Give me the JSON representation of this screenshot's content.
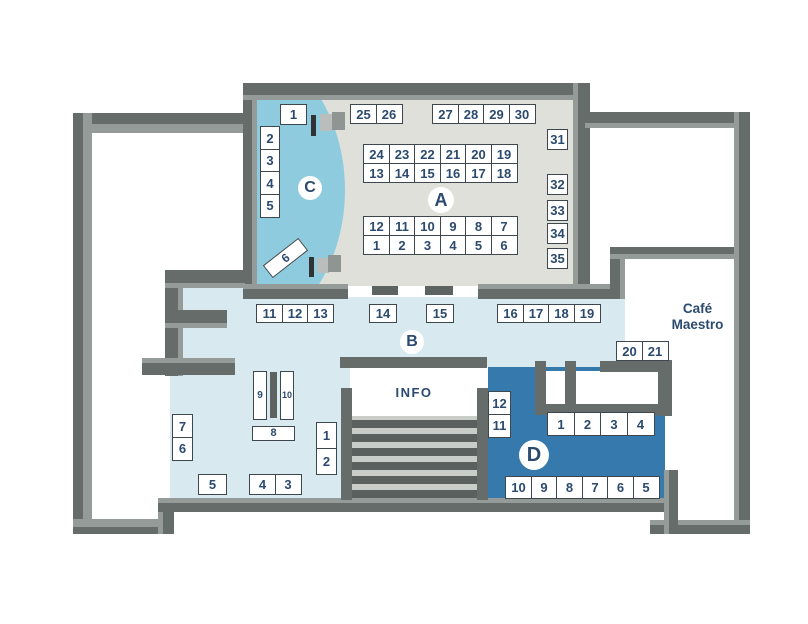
{
  "labels": {
    "info": "INFO",
    "cafe_line1": "Café",
    "cafe_line2": "Maestro"
  },
  "colors": {
    "wd": "#666c69",
    "wl": "#959b98",
    "wm": "#5d6360",
    "floor_a": "#e0e0db",
    "zone_b": "#d8eaf0",
    "zone_c": "#8ecbdf",
    "zone_d": "#3579ad",
    "stairs_bg": "#c9cdc9",
    "stair_step": "#5a605d",
    "booth_border": "#3e474d",
    "text": "#2b4a6e",
    "door_dark": "#2f3335",
    "door_grey1": "#b9bdbb",
    "door_grey2": "#8f9592"
  },
  "zones": [
    {
      "label": "A",
      "cx": 441,
      "cy": 200,
      "r": 13
    },
    {
      "label": "B",
      "cx": 412,
      "cy": 342,
      "r": 12
    },
    {
      "label": "C",
      "cx": 310,
      "cy": 188,
      "r": 12
    },
    {
      "label": "D",
      "cx": 534,
      "cy": 455,
      "r": 15
    }
  ],
  "booth_groups": [
    {
      "zone": "A",
      "x": 350,
      "y": 104,
      "cw": 27,
      "ch": 20,
      "cells": [
        "25",
        "26"
      ]
    },
    {
      "zone": "A",
      "x": 432,
      "y": 104,
      "cw": 27,
      "ch": 20,
      "cells": [
        "27",
        "28",
        "29",
        "30"
      ]
    },
    {
      "zone": "A",
      "x": 363,
      "y": 144,
      "cw": 27,
      "ch": 20,
      "cells": [
        "24",
        "23",
        "22",
        "21",
        "20",
        "19"
      ]
    },
    {
      "zone": "A",
      "x": 363,
      "y": 163,
      "cw": 27,
      "ch": 20,
      "cells": [
        "13",
        "14",
        "15",
        "16",
        "17",
        "18"
      ]
    },
    {
      "zone": "A",
      "x": 363,
      "y": 216,
      "cw": 27,
      "ch": 20,
      "cells": [
        "12",
        "11",
        "10",
        "9",
        "8",
        "7"
      ]
    },
    {
      "zone": "A",
      "x": 363,
      "y": 235,
      "cw": 27,
      "ch": 20,
      "cells": [
        "1",
        "2",
        "3",
        "4",
        "5",
        "6"
      ]
    },
    {
      "zone": "A",
      "x": 547,
      "y": 129,
      "cw": 21,
      "ch": 21,
      "cells": [
        "31"
      ]
    },
    {
      "zone": "A",
      "x": 547,
      "y": 174,
      "cw": 21,
      "ch": 21,
      "cells": [
        "32"
      ]
    },
    {
      "zone": "A",
      "x": 547,
      "y": 200,
      "cw": 21,
      "ch": 21,
      "cells": [
        "33"
      ]
    },
    {
      "zone": "A",
      "x": 547,
      "y": 223,
      "cw": 21,
      "ch": 21,
      "cells": [
        "34"
      ]
    },
    {
      "zone": "A",
      "x": 547,
      "y": 248,
      "cw": 21,
      "ch": 21,
      "cells": [
        "35"
      ]
    },
    {
      "zone": "C",
      "x": 280,
      "y": 104,
      "cw": 27,
      "ch": 21,
      "cells": [
        "1"
      ]
    },
    {
      "zone": "C",
      "x": 260,
      "y": 126,
      "dir": "col",
      "cw": 20,
      "ch": 24,
      "cells": [
        "2",
        "3",
        "4",
        "5"
      ]
    },
    {
      "zone": "C",
      "x": 263,
      "y": 250,
      "cw": 45,
      "ch": 16,
      "cells": [
        "6"
      ],
      "rot": -38,
      "fs": 12
    },
    {
      "zone": "B",
      "x": 256,
      "y": 304,
      "cw": 27,
      "ch": 19,
      "cells": [
        "11",
        "12",
        "13"
      ]
    },
    {
      "zone": "B",
      "x": 369,
      "y": 304,
      "cw": 28,
      "ch": 19,
      "cells": [
        "14"
      ]
    },
    {
      "zone": "B",
      "x": 426,
      "y": 304,
      "cw": 28,
      "ch": 19,
      "cells": [
        "15"
      ]
    },
    {
      "zone": "B",
      "x": 497,
      "y": 304,
      "cw": 27,
      "ch": 19,
      "cells": [
        "16",
        "17",
        "18",
        "19"
      ]
    },
    {
      "zone": "B",
      "x": 616,
      "y": 341,
      "cw": 27,
      "ch": 20,
      "cells": [
        "20",
        "21"
      ]
    },
    {
      "zone": "B",
      "x": 172,
      "y": 414,
      "dir": "col",
      "cw": 21,
      "ch": 24,
      "cells": [
        "7",
        "6"
      ]
    },
    {
      "zone": "B",
      "x": 198,
      "y": 474,
      "cw": 29,
      "ch": 21,
      "cells": [
        "5"
      ]
    },
    {
      "zone": "B",
      "x": 249,
      "y": 474,
      "cw": 27,
      "ch": 21,
      "cells": [
        "4",
        "3"
      ]
    },
    {
      "zone": "B",
      "x": 253,
      "y": 371,
      "cw": 14,
      "ch": 49,
      "cells": [
        "9"
      ],
      "fs": 10
    },
    {
      "zone": "B",
      "x": 280,
      "y": 371,
      "cw": 14,
      "ch": 49,
      "cells": [
        "10"
      ],
      "fs": 9
    },
    {
      "zone": "B",
      "x": 252,
      "y": 426,
      "cw": 43,
      "ch": 15,
      "cells": [
        "8"
      ],
      "fs": 11
    },
    {
      "zone": "B",
      "x": 316,
      "y": 422,
      "dir": "col",
      "cw": 21,
      "ch": 27,
      "cells": [
        "1",
        "2"
      ]
    },
    {
      "zone": "D",
      "x": 488,
      "y": 391,
      "dir": "col",
      "cw": 23,
      "ch": 24,
      "cells": [
        "12",
        "11"
      ]
    },
    {
      "zone": "D",
      "x": 547,
      "y": 412,
      "cw": 28,
      "ch": 24,
      "cells": [
        "1",
        "2",
        "3",
        "4"
      ]
    },
    {
      "zone": "D",
      "x": 505,
      "y": 476,
      "cw": 27,
      "ch": 23,
      "cells": [
        "10",
        "9",
        "8",
        "7",
        "6",
        "5"
      ]
    }
  ]
}
